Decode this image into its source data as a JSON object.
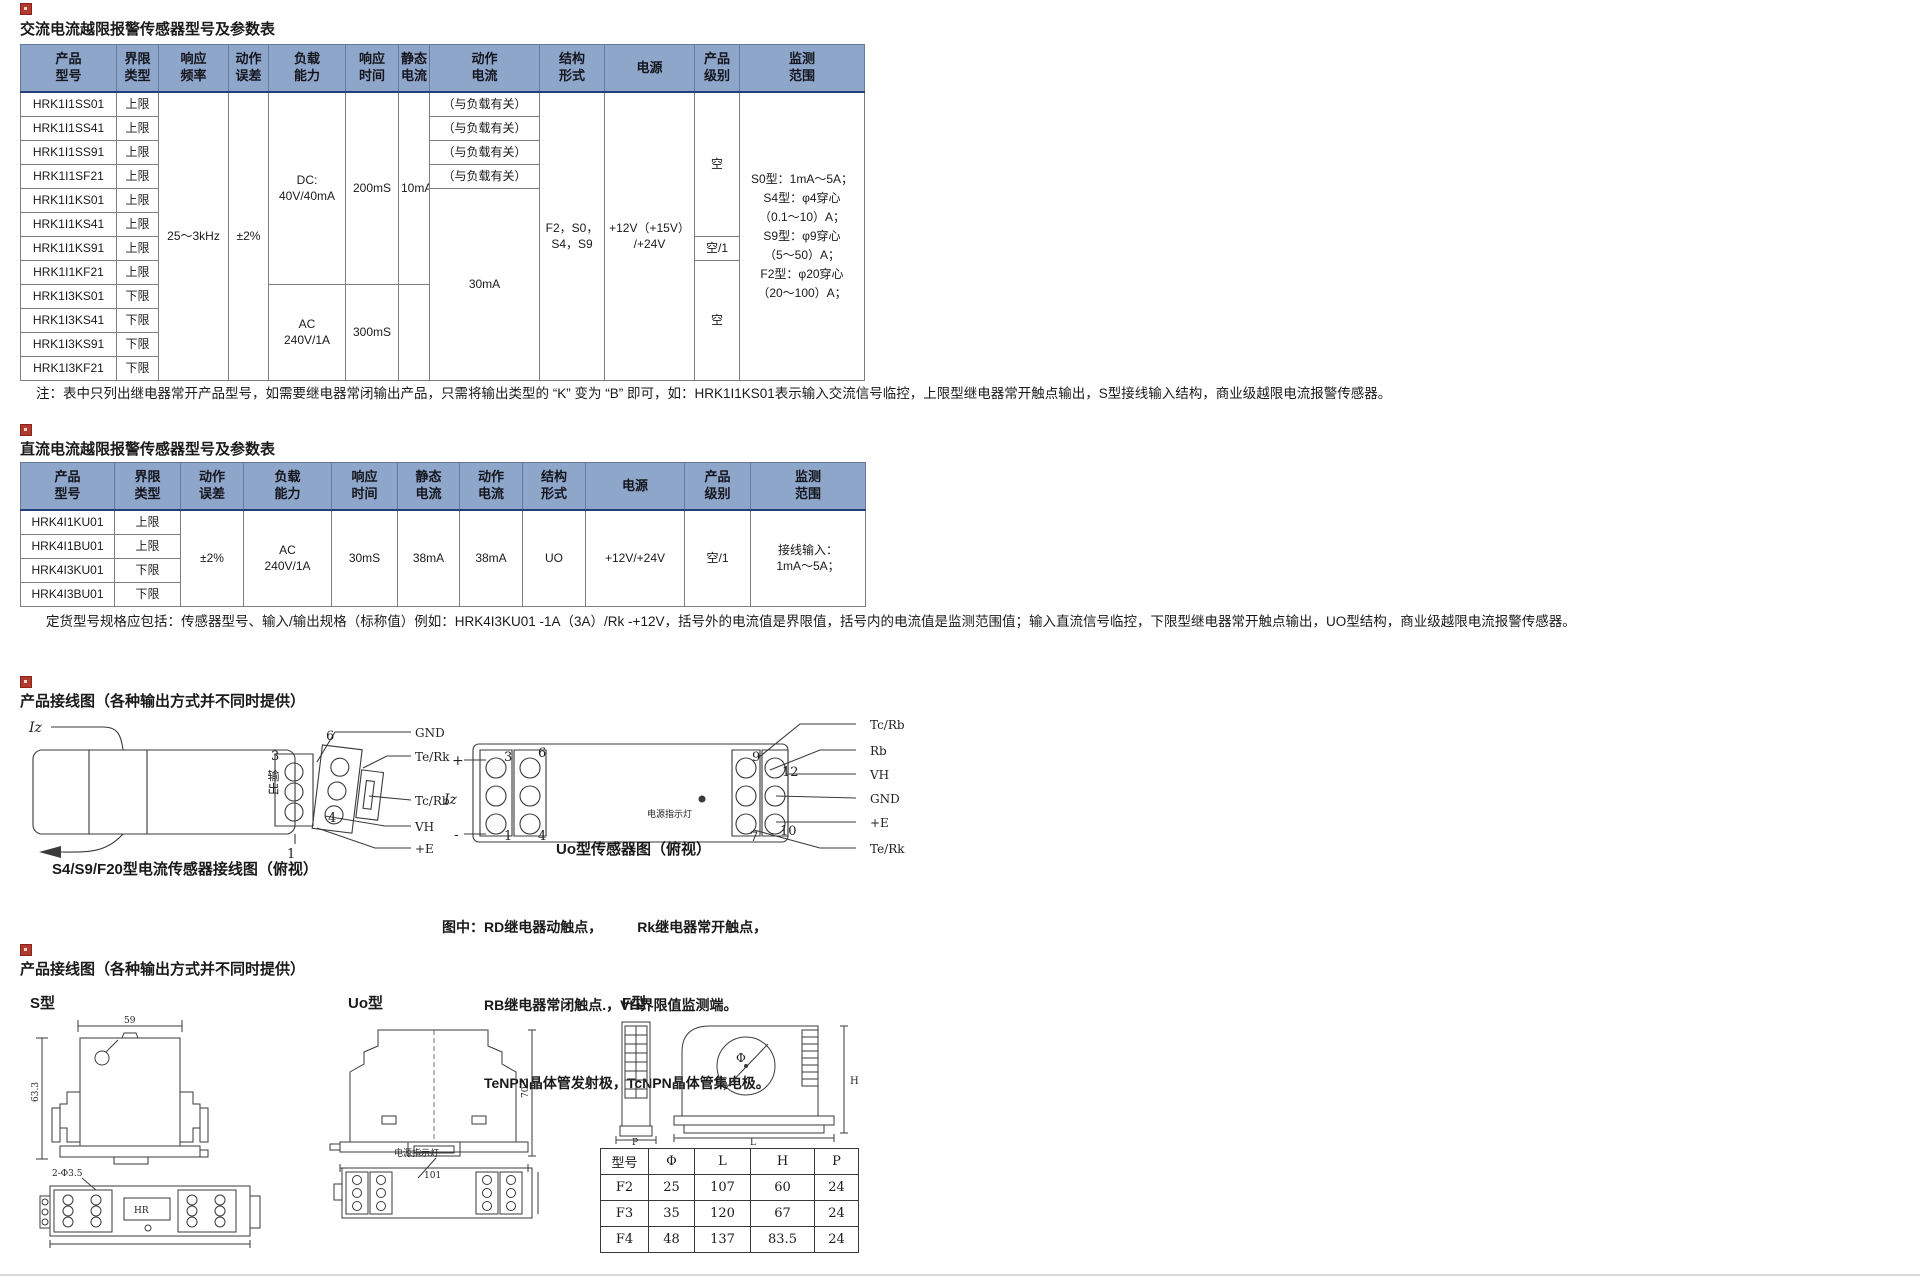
{
  "t1": {
    "title": "交流电流越限报警传感器型号及参数表",
    "headers": [
      "产品\n型号",
      "界限\n类型",
      "响应\n频率",
      "动作\n误差",
      "负载\n能力",
      "响应\n时间",
      "静态\n电流",
      "动作\n电流",
      "结构\n形式",
      "电源",
      "产品\n级别",
      "监测\n范围"
    ],
    "rows": [
      {
        "model": "HRK1I1SS01",
        "limit": "上限",
        "action": "（与负载有关）"
      },
      {
        "model": "HRK1I1SS41",
        "limit": "上限",
        "action": "（与负载有关）"
      },
      {
        "model": "HRK1I1SS91",
        "limit": "上限",
        "action": "（与负载有关）"
      },
      {
        "model": "HRK1I1SF21",
        "limit": "上限",
        "action": "（与负载有关）"
      },
      {
        "model": "HRK1I1KS01",
        "limit": "上限"
      },
      {
        "model": "HRK1I1KS41",
        "limit": "上限"
      },
      {
        "model": "HRK1I1KS91",
        "limit": "上限"
      },
      {
        "model": "HRK1I1KF21",
        "limit": "上限"
      },
      {
        "model": "HRK1I3KS01",
        "limit": "下限"
      },
      {
        "model": "HRK1I3KS41",
        "limit": "下限"
      },
      {
        "model": "HRK1I3KS91",
        "limit": "下限"
      },
      {
        "model": "HRK1I3KF21",
        "limit": "下限"
      }
    ],
    "merged": {
      "freq": "25～3kHz",
      "err": "±2%",
      "load_dc": "DC:\n40V/40mA",
      "resp_dc": "200mS",
      "static_dc": "10mA",
      "action_rest": "30mA",
      "load_ac": "AC\n240V/1A",
      "resp_ac": "300mS",
      "static_ac": "",
      "struct": "F2，S0，\nS4，S9",
      "power": "+12V（+15V）\n/+24V",
      "grade_top": "空",
      "grade_mid": "空/1",
      "grade_bot": "空",
      "range": "S0型：1mA～5A；\nS4型：φ4穿心\n（0.1～10）A；\nS9型：φ9穿心\n（5～50）A；\nF2型：φ20穿心\n（20～100）A；"
    },
    "note": "注：表中只列出继电器常开产品型号，如需要继电器常闭输出产品，只需将输出类型的 “K” 变为 “B” 即可，如：HRK1I1KS01表示输入交流信号临控，上限型继电器常开触点输出，S型接线输入结构，商业级越限电流报警传感器。"
  },
  "t2": {
    "title": "直流电流越限报警传感器型号及参数表",
    "headers": [
      "产品\n型号",
      "界限\n类型",
      "动作\n误差",
      "负载\n能力",
      "响应\n时间",
      "静态\n电流",
      "动作\n电流",
      "结构\n形式",
      "电源",
      "产品\n级别",
      "监测\n范围"
    ],
    "rows": [
      {
        "model": "HRK4I1KU01",
        "limit": "上限"
      },
      {
        "model": "HRK4I1BU01",
        "limit": "上限"
      },
      {
        "model": "HRK4I3KU01",
        "limit": "下限"
      },
      {
        "model": "HRK4I3BU01",
        "limit": "下限"
      }
    ],
    "merged": {
      "err": "±2%",
      "load": "AC\n240V/1A",
      "resp": "30mS",
      "static": "38mA",
      "action": "38mA",
      "struct": "UO",
      "power": "+12V/+24V",
      "grade": "空/1",
      "range": "接线输入：\n1mA～5A；"
    },
    "order_note": "定货型号规格应包括：传感器型号、输入/输出规格（标称值）例如：HRK4I3KU01 -1A（3A）/Rk -+12V，括号外的电流值是界限值，括号内的电流值是监测范围值；输入直流信号临控，下限型继电器常开触点输出，UO型结构，商业级越限电流报警传感器。"
  },
  "w1": {
    "heading": "产品接线图（各种输出方式并不同时提供）",
    "left": {
      "iz": "Iz",
      "out": "输出",
      "p3": "3",
      "p6": "6",
      "p4": "4",
      "p1": "1",
      "gnd": "GND",
      "terk": "Te/Rk",
      "tcrb": "Tc/Rb",
      "vh": "VH",
      "pe": "+E",
      "caption": "S4/S9/F20型电流传感器接线图（俯视）"
    },
    "mid": {
      "plus": "+",
      "iz": "Iz",
      "minus": "-",
      "p3": "3",
      "p6": "6",
      "p1": "1",
      "p4": "4",
      "p9": "9",
      "p12": "12",
      "p7": "7",
      "p10": "10",
      "led": "电源指示灯",
      "tcrb": "Tc/Rb",
      "rb": "Rb",
      "vh": "VH",
      "gnd": "GND",
      "pe": "+E",
      "terk": "Te/Rk",
      "caption": "Uo型传感器图（俯视）"
    },
    "legend": {
      "l1": "图中：RD继电器动触点，　　　Rk继电器常开触点，",
      "l2": "RB继电器常闭触点.，VH界限值监测端。",
      "l3": "TeNPN晶体管发射极，TcNPN晶体管集电极。"
    }
  },
  "w2": {
    "heading": "产品接线图（各种输出方式并不同时提供）",
    "s_label": "S型",
    "uo_label": "Uo型",
    "f_label": "F型",
    "s": {
      "d59": "59",
      "d633": "63.3",
      "holes": "2-Φ3.5",
      "hr": "HR"
    },
    "uo": {
      "d705": "70.5",
      "d101": "101",
      "led": "电源指示灯"
    },
    "f": {
      "p": "P",
      "l": "L",
      "h": "H",
      "phi": "Φ"
    },
    "ftable": {
      "headers": [
        "型号",
        "Φ",
        "L",
        "H",
        "P"
      ],
      "rows": [
        [
          "F2",
          "25",
          "107",
          "60",
          "24"
        ],
        [
          "F3",
          "35",
          "120",
          "67",
          "24"
        ],
        [
          "F4",
          "48",
          "137",
          "83.5",
          "24"
        ]
      ]
    }
  }
}
